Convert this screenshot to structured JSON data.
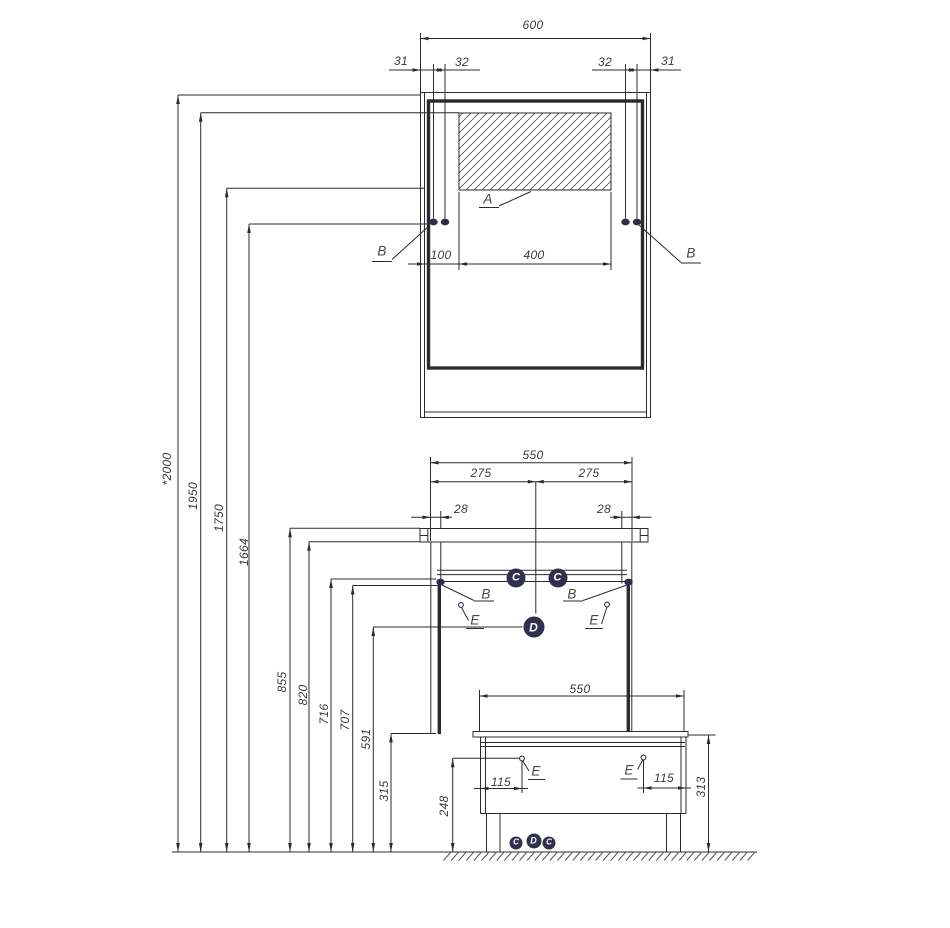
{
  "colors": {
    "line": "#2b2b2e",
    "badge_fill": "#31304e",
    "text": "#3a3a3c",
    "paper": "#ffffff"
  },
  "upper_cabinet_dims": {
    "overall_width": "600",
    "side_inset": "31",
    "hole_offset": "32",
    "hole_inset": "100",
    "hole_span": "400"
  },
  "height_dims": {
    "h2000": "*2000",
    "h1950": "1950",
    "h1750": "1750",
    "h1664": "1664",
    "h855": "855",
    "h820": "820",
    "h716": "716",
    "h707": "707",
    "h591": "591",
    "h315": "315",
    "h248": "248",
    "h313": "313"
  },
  "vanity_dims": {
    "body_width": "550",
    "half_span": "275",
    "wall_inset": "28"
  },
  "bench_dims": {
    "body_width": "550",
    "fastener_inset": "115"
  },
  "callouts": {
    "a": "A",
    "b": "B",
    "c": "C",
    "d": "D",
    "e": "E"
  }
}
